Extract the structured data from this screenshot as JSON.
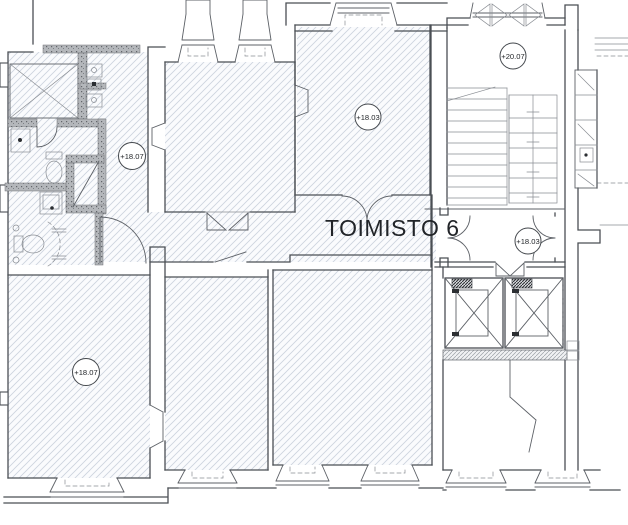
{
  "plan": {
    "title": "TOIMISTO 6",
    "markers": [
      {
        "name": "hall-level",
        "label": "+18.07"
      },
      {
        "name": "office-mid-level",
        "label": "+18.03"
      },
      {
        "name": "stair-top-level",
        "label": "+20.07"
      },
      {
        "name": "lobby-level",
        "label": "+18.03"
      },
      {
        "name": "office-left-level",
        "label": "+18.07"
      }
    ],
    "colors": {
      "background": "#ffffff",
      "hatch_line": "#ccd3de",
      "room_tint": "#fafbfd",
      "wall_line": "#4b4f55",
      "renovated_wall_fill": "#b4b7bb",
      "text": "#23262a"
    }
  }
}
